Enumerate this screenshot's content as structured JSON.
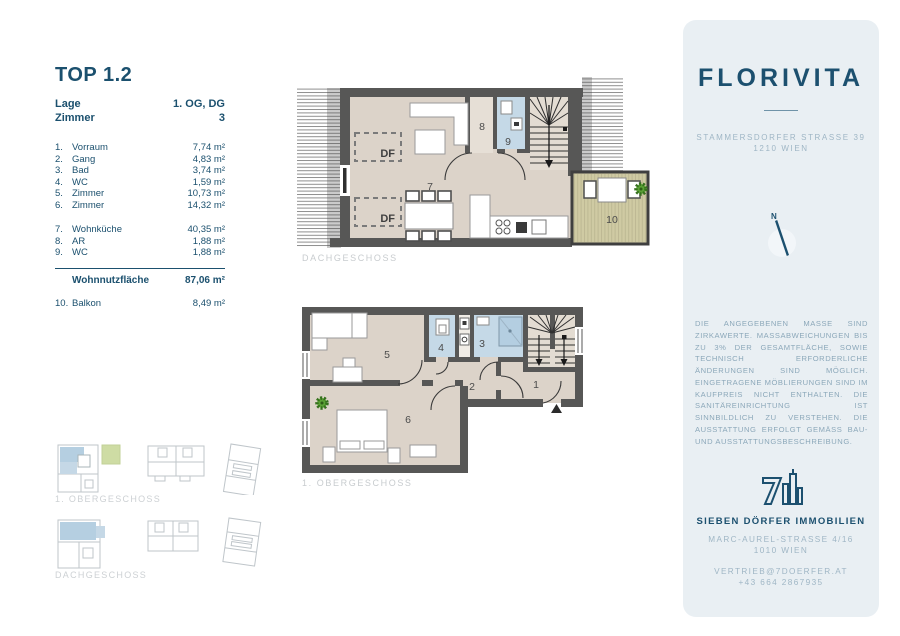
{
  "unit": {
    "title": "TOP 1.2",
    "info": [
      {
        "label": "Lage",
        "value": "1. OG, DG"
      },
      {
        "label": "Zimmer",
        "value": "3"
      }
    ],
    "rooms": [
      {
        "no": "1.",
        "name": "Vorraum",
        "area": "7,74 m²"
      },
      {
        "no": "2.",
        "name": "Gang",
        "area": "4,83 m²"
      },
      {
        "no": "3.",
        "name": "Bad",
        "area": "3,74 m²"
      },
      {
        "no": "4.",
        "name": "WC",
        "area": "1,59 m²"
      },
      {
        "no": "5.",
        "name": "Zimmer",
        "area": "10,73 m²"
      },
      {
        "no": "6.",
        "name": "Zimmer",
        "area": "14,32 m²"
      },
      {
        "no": "7.",
        "name": "Wohnküche",
        "area": "40,35 m²"
      },
      {
        "no": "8.",
        "name": "AR",
        "area": "1,88 m²"
      },
      {
        "no": "9.",
        "name": "WC",
        "area": "1,88 m²"
      }
    ],
    "total": {
      "label": "Wohnnutzfläche",
      "value": "87,06 m²"
    },
    "extra": {
      "no": "10.",
      "name": "Balkon",
      "area": "8,49 m²"
    }
  },
  "plans": {
    "upper": {
      "label": "DACHGESCHOSS",
      "numbers": [
        "7",
        "8",
        "9",
        "10"
      ],
      "df_label": "DF"
    },
    "lower": {
      "label": "1. OBERGESCHOSS",
      "numbers": [
        "1",
        "2",
        "3",
        "4",
        "5",
        "6"
      ]
    }
  },
  "keyplans": {
    "upper_label": "1. OBERGESCHOSS",
    "lower_label": "DACHGESCHOSS"
  },
  "sidebar": {
    "brand": "FLORIVITA",
    "address_line1": "STAMMERSDORFER STRASSE 39",
    "address_line2": "1210 WIEN",
    "compass_label": "N",
    "disclaimer": "DIE ANGEGEBENEN MASSE SIND ZIRKAWERTE. MASSABWEICHUNGEN BIS ZU 3% DER GESAMTFLÄCHE, SOWIE TECHNISCH ERFORDERLICHE ÄNDERUNGEN SIND MÖGLICH. EINGETRAGENE MÖBLIERUNGEN SIND IM KAUFPREIS NICHT ENTHALTEN. DIE SANITÄREINRICHTUNG IST SINNBILDLICH ZU VERSTEHEN. DIE AUSSTATTUNG ERFOLGT GEMÄSS BAU- UND AUSSTATTUNGSBESCHREIBUNG.",
    "company": "SIEBEN DÖRFER IMMOBILIEN",
    "company_address1": "MARC-AUREL-STRASSE 4/16",
    "company_address2": "1010 WIEN",
    "contact_email": "VERTRIEB@7DOERFER.AT",
    "contact_phone": "+43 664 2867935"
  },
  "colors": {
    "brand_navy": "#1C506F",
    "muted_blue": "#9FB6C5",
    "panel_bg": "#E9EFF3",
    "wall_gray": "#575756",
    "floor_beige": "#DCD3C9",
    "wet_room_blue": "#C5D9E7",
    "balcony_tan": "#CFCAA3",
    "keyplan_blue": "#A9C7DC",
    "keyplan_green": "#C6D795",
    "plan_label_gray": "#C8CCCF",
    "plant_green": "#5AA135"
  }
}
